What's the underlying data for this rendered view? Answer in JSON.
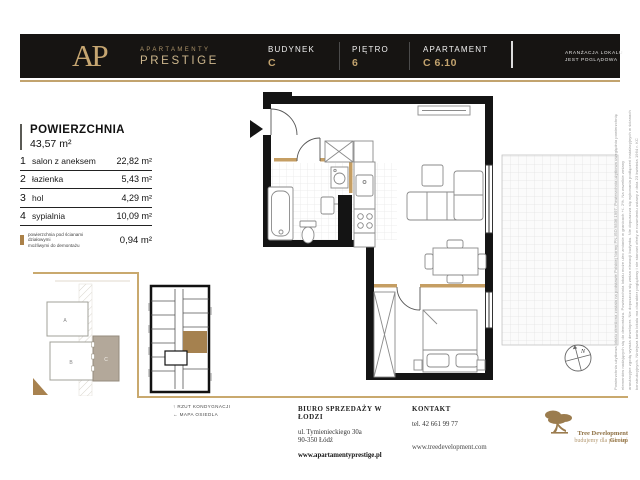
{
  "header": {
    "logo": {
      "monogram": "AP",
      "line1": "APARTAMENTY",
      "line2": "PRESTIGE"
    },
    "fields": [
      {
        "label": "BUDYNEK",
        "value": "C"
      },
      {
        "label": "PIĘTRO",
        "value": "6"
      },
      {
        "label": "APARTAMENT",
        "value": "C 6.10"
      }
    ],
    "note": {
      "line1": "ARANŻACJA LOKALU",
      "line2": "JEST POGLĄDOWA"
    }
  },
  "area_panel": {
    "title": "POWIERZCHNIA",
    "total": "43,57 m²",
    "rooms": [
      {
        "no": "1",
        "name": "salon z aneksem",
        "area": "22,82 m²"
      },
      {
        "no": "2",
        "name": "łazienka",
        "area": "5,43 m²"
      },
      {
        "no": "3",
        "name": "hol",
        "area": "4,29 m²"
      },
      {
        "no": "4",
        "name": "sypialnia",
        "area": "10,09 m²"
      }
    ],
    "partition_note": {
      "line1": "powierzchnia pod ścianami działowymi",
      "line2": "możliwymi do demontażu",
      "value": "0,94 m²"
    }
  },
  "site_map": {
    "building_a": "A",
    "building_b": "B",
    "building_c": "C"
  },
  "plan": {
    "compass": "N"
  },
  "mini_labels": {
    "floor_plan": "↑ RZUT KONDYGNACJI",
    "site_map": "← MAPA OSIEDLA"
  },
  "footer": {
    "office_title": "BIURO SPRZEDAŻY W ŁODZI",
    "office_addr1": "ul. Tymienieckiego 30a",
    "office_addr2": "90-350 Łódź",
    "office_site": "www.apartamentyprestige.pl",
    "contact_title": "KONTAKT",
    "contact_phone": "tel. 42 661 99 77",
    "contact_site": "www.treedevelopment.com",
    "brand_name": "Tree Development Group",
    "brand_slogan": "budujemy dla pokoleń"
  },
  "disclaimer": {
    "line1": "Powierzchnia użytkowa lokalu określona została na podstawie Polskiej Normy PN-ISO 9836:1997. Powierzchnia użytkowa uwzględnia powierzchnię elementów nadających się do demontażu. Powierzchnia lokalu może ulec zmianie w granicach +/- 2%. Na wszelkie zmiany",
    "line2": "aranżacyjne zgodę wyraża deweloper. Nie dopuszcza się zmian elewacji budynku. Nie dopuszcza się wykonania podłączeń instalacyjnych w ścianach konstrukcyjnych. Niniejsza karta lokalu ma charakter poglądowy i nie stanowi oferty w rozumieniu ustawy z dnia 23 kwietnia 1964 r. KC"
  },
  "colors": {
    "gold": "#c2a36e",
    "black": "#161412",
    "brown": "#9b7c4e",
    "unit_highlight": "#a5814f"
  }
}
